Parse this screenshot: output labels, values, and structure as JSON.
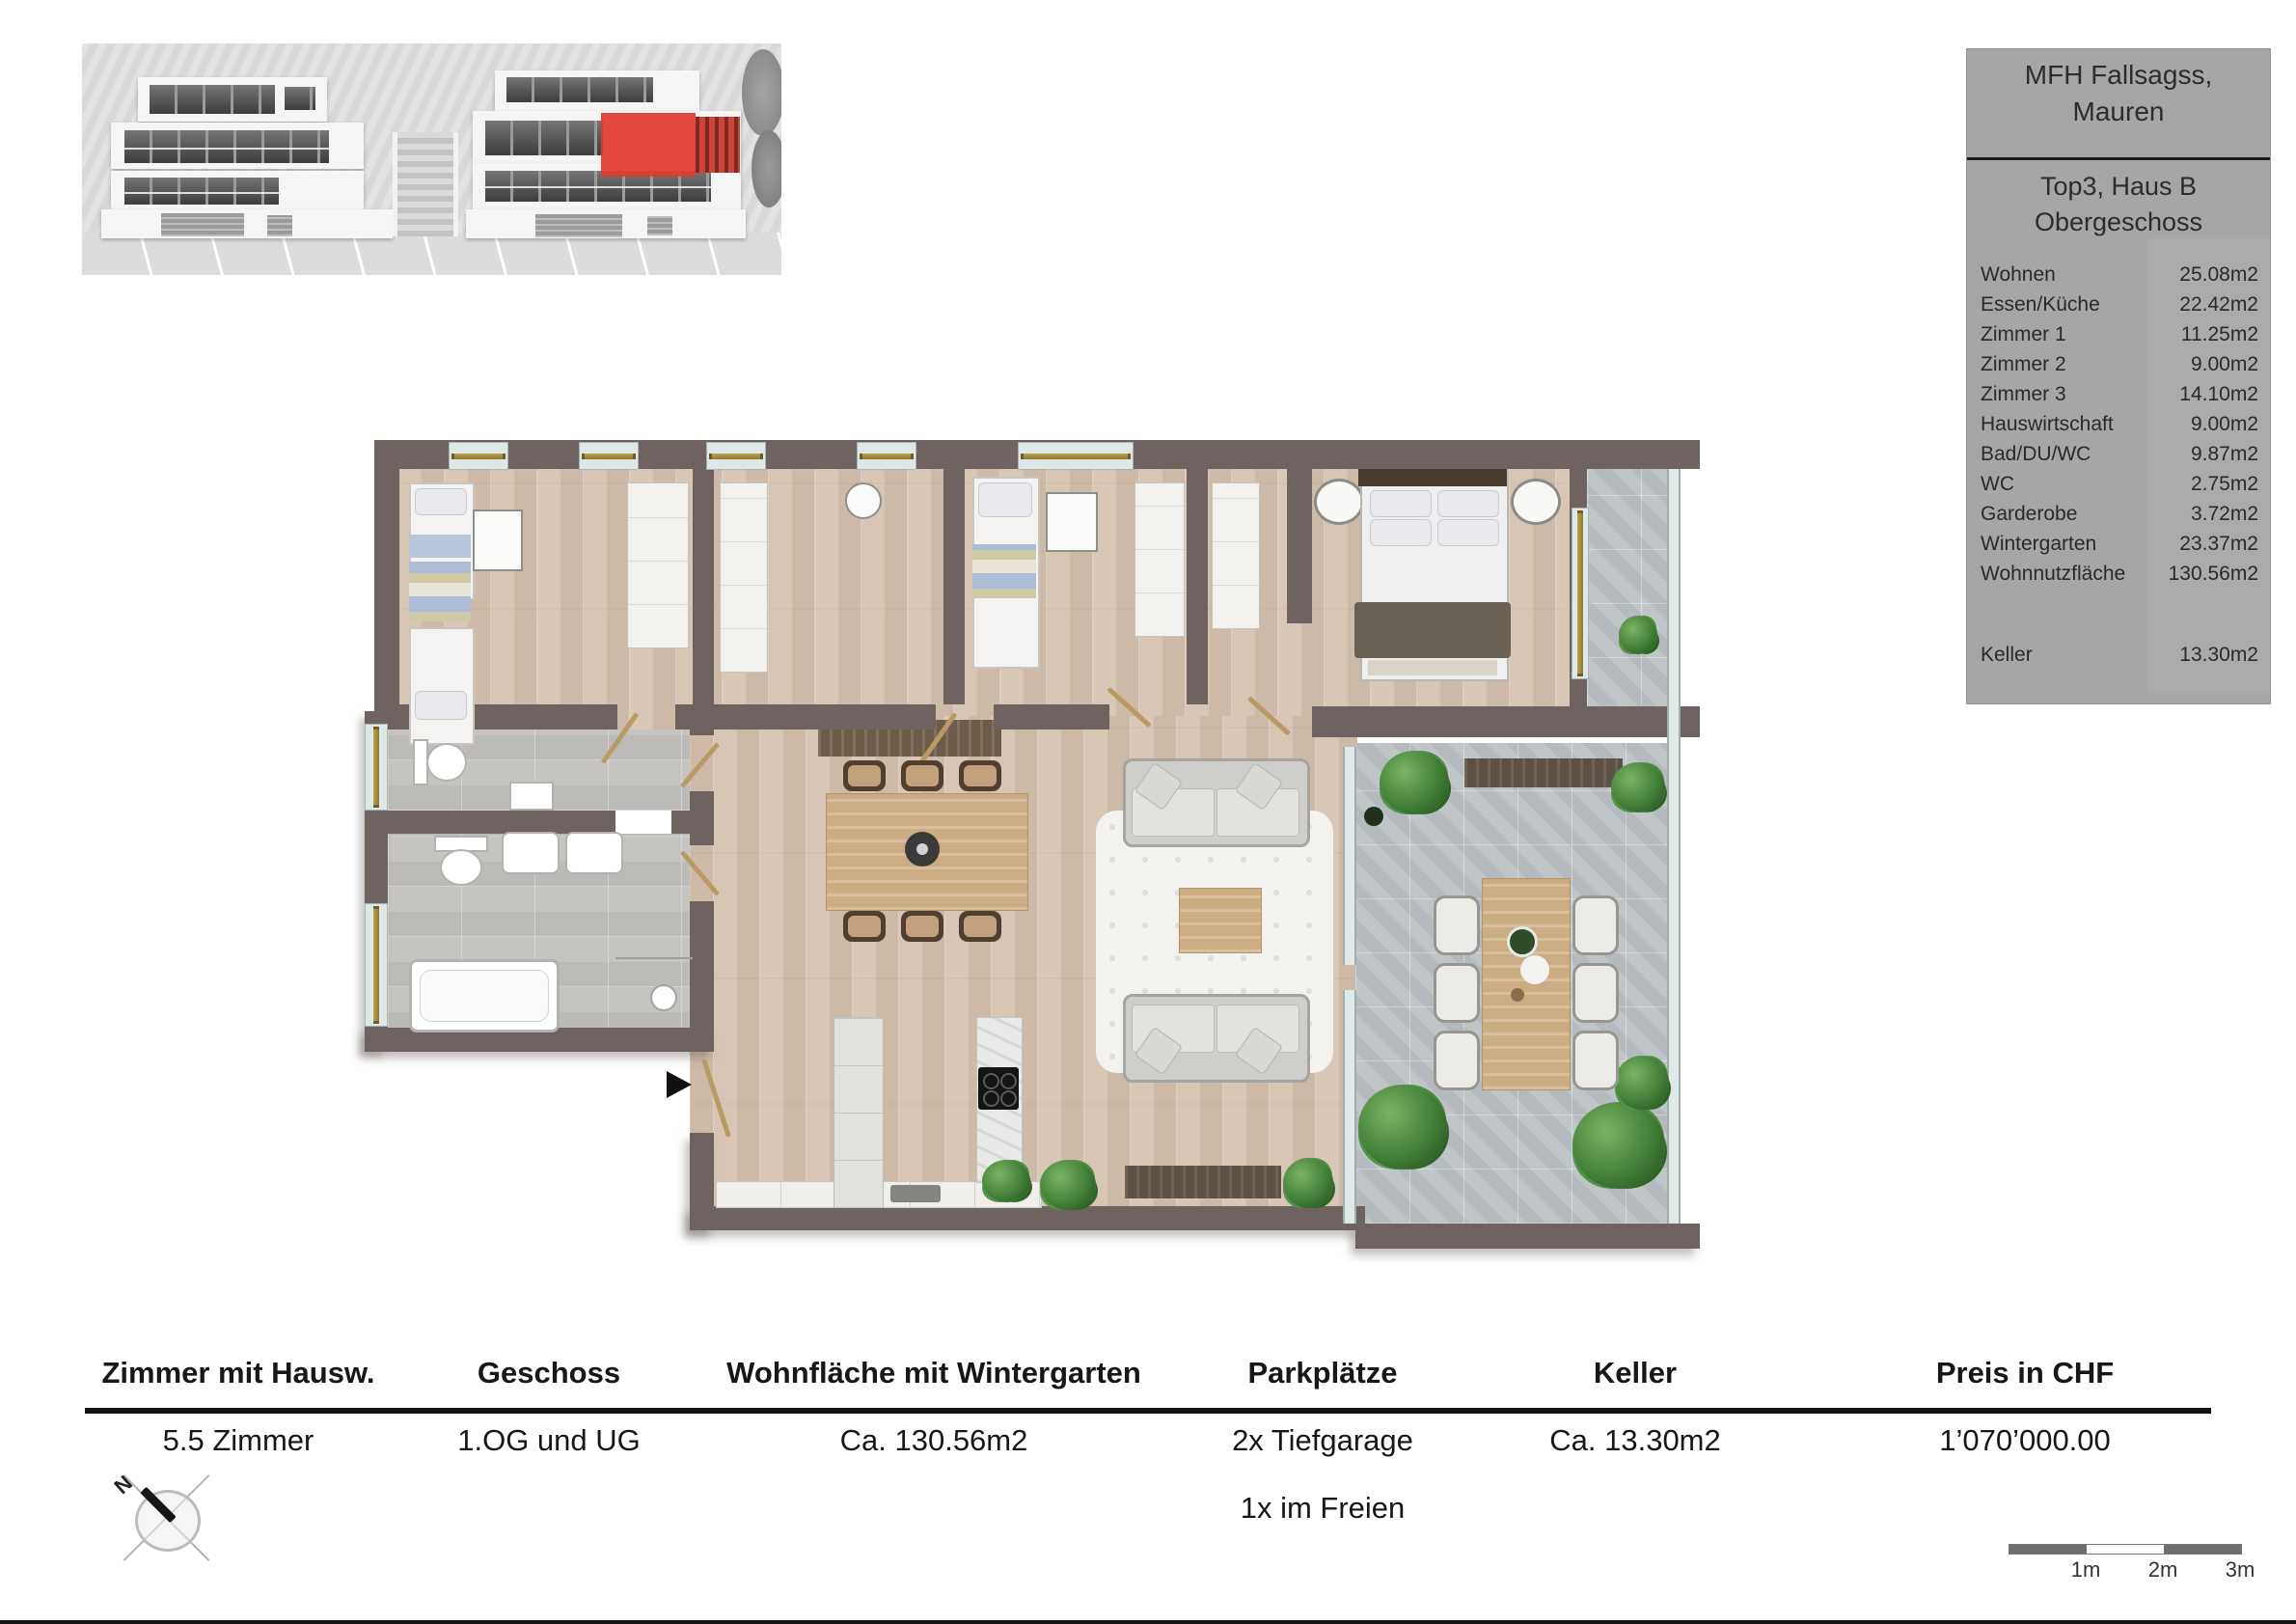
{
  "info_panel": {
    "title_line1": "MFH Fallsagss,",
    "title_line2": "Mauren",
    "subtitle_line1": "Top3, Haus B",
    "subtitle_line2": "Obergeschoss",
    "rooms": [
      {
        "label": "Wohnen",
        "value": "25.08m2"
      },
      {
        "label": "Essen/Küche",
        "value": "22.42m2"
      },
      {
        "label": "Zimmer 1",
        "value": "11.25m2"
      },
      {
        "label": "Zimmer 2",
        "value": "9.00m2"
      },
      {
        "label": "Zimmer 3",
        "value": "14.10m2"
      },
      {
        "label": "Hauswirtschaft",
        "value": "9.00m2"
      },
      {
        "label": "Bad/DU/WC",
        "value": "9.87m2"
      },
      {
        "label": "WC",
        "value": "2.75m2"
      },
      {
        "label": "Garderobe",
        "value": "3.72m2"
      },
      {
        "label": "Wintergarten",
        "value": "23.37m2"
      },
      {
        "label": "Wohnnutzfläche",
        "value": "130.56m2"
      }
    ],
    "keller": {
      "label": "Keller",
      "value": "13.30m2"
    }
  },
  "summary_table": {
    "columns": [
      {
        "header": "Zimmer mit Hausw.",
        "value": "5.5 Zimmer",
        "value2": ""
      },
      {
        "header": "Geschoss",
        "value": "1.OG und UG",
        "value2": ""
      },
      {
        "header": "Wohnfläche mit Wintergarten",
        "value": "Ca. 130.56m2",
        "value2": ""
      },
      {
        "header": "Parkplätze",
        "value": "2x Tiefgarage",
        "value2": "1x im Freien"
      },
      {
        "header": "Keller",
        "value": "Ca. 13.30m2",
        "value2": ""
      },
      {
        "header": "Preis in CHF",
        "value": "1’070’000.00",
        "value2": ""
      }
    ]
  },
  "scale_bar": {
    "labels": [
      "1m",
      "2m",
      "3m"
    ]
  },
  "compass": {
    "north_label": "N"
  },
  "colors": {
    "accent_red": "#e23a2c",
    "wall": "#6f6361",
    "panel_gray": "#a6a6a6"
  }
}
